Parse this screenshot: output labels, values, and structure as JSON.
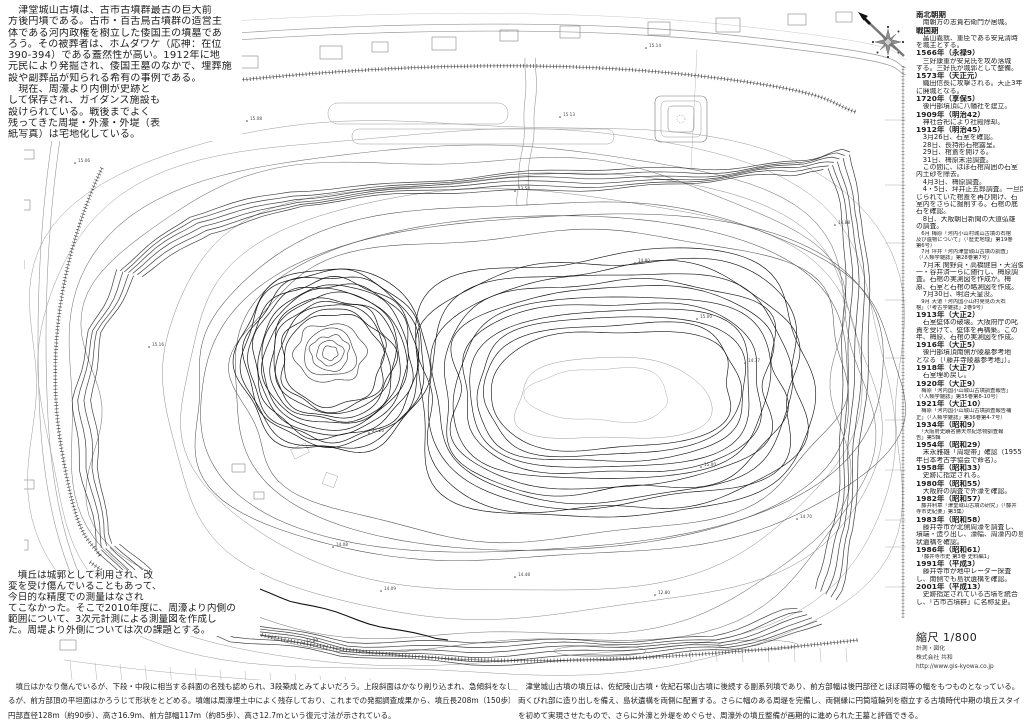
{
  "title": "津堂城山古墳 測量図",
  "intro": {
    "lines": [
      "　津堂城山古墳は、古市古墳群最古の巨大前",
      "方後円墳である。古市・百舌鳥古墳群の造営主",
      "体である河内政権を樹立した倭国王の墳墓であ",
      "ろう。その被葬者は、ホムダワケ（応神：在位",
      "390-394）である蓋然性が高い。1912年に地",
      "元民により発掘され、倭国王墓のなかで、埋葬施",
      "設や副葬品が知られる希有の事例である。",
      "　現在、周濠より内側が史跡と",
      "して保存され、ガイダンス施設も",
      "設けられている。戦後までよく",
      "残ってきた周堤・外濠・外堤（表",
      "紙写真）は宅地化している。"
    ]
  },
  "note": {
    "lines": [
      "　墳丘は城郭として利用され、改",
      "変を受け傷んでいることもあって、",
      "今日的な精度での測量はなされ",
      "てこなかった。そこで2010年度に、周濠より内側の",
      "範囲について、3次元計測による測量図を作成し",
      "た。周堤より外側については次の課題とする。"
    ]
  },
  "footer_left": {
    "lines": [
      "　墳丘はかなり傷んでいるが、下段・中段に相当する斜面の名残も認められ、3段築成とみてよいだろう。上段斜面はかなり削り込まれ、急傾斜をなしてい",
      "るが、前方部頂の平坦面はかろうじて形状をとどめる。墳端は周濠埋土中によく残存しており、これまでの発掘調査成果から、墳丘長208m（150歩）、後",
      "円部直径128m（約90歩）、高さ16.9m、前方部幅117m（約85歩）、高さ12.7mという復元寸法が示されている。"
    ]
  },
  "footer_right": {
    "lines": [
      "　津堂城山古墳の墳丘は、佐紀陵山古墳・佐紀石塚山古墳に後続する副系列墳であり、前方部幅は後円部径とほぼ同等の幅をもつものとなっている。",
      "両くびれ部に造り出しを備え、島状遺構を両側に配置する。さらに幅のある周堤を完備し、両側縁に円筒埴輪列を樹立する古墳時代中期の墳丘スタイル",
      "を初めて実現させたもので、さらに外濠と外堤をめぐらせ、周濠外の墳丘整備が画期的に進められた王墓と評価できる。"
    ]
  },
  "timeline": {
    "entries": [
      {
        "c": "year",
        "t": "南北朝期"
      },
      {
        "c": "body",
        "t": "　南朝方の志貴右衛門が居城。"
      },
      {
        "c": "year",
        "t": "戦国期"
      },
      {
        "c": "body",
        "t": "　畠山義就、重臣である安見清時"
      },
      {
        "c": "body",
        "t": "を城主とする。"
      },
      {
        "c": "year",
        "t": "1566年（永禄9）"
      },
      {
        "c": "body",
        "t": "　三好康重が安見氏を攻め落城"
      },
      {
        "c": "body",
        "t": "する。三好氏が城郭として整備。"
      },
      {
        "c": "year",
        "t": "1573年（天正元）"
      },
      {
        "c": "body",
        "t": "　織田信長に攻撃される。天正3年"
      },
      {
        "c": "body",
        "t": "に廃城となる。"
      },
      {
        "c": "year",
        "t": "1720年（享保5）"
      },
      {
        "c": "body",
        "t": "　後円部墳頂に八幡社を建立。"
      },
      {
        "c": "year",
        "t": "1909年（明治42）"
      },
      {
        "c": "body",
        "t": "　神社合祀により社殿除却。"
      },
      {
        "c": "year",
        "t": "1912年（明治45）"
      },
      {
        "c": "body",
        "t": "　3月26日、石室を確認。"
      },
      {
        "c": "body",
        "t": "　28日、長持形石棺露呈。"
      },
      {
        "c": "body",
        "t": "　29日、棺蓋を開ける。"
      },
      {
        "c": "body",
        "t": "　31日、梅原末治調査。"
      },
      {
        "c": "body",
        "t": "　この間に、ほぼ石棺周囲の石室"
      },
      {
        "c": "body",
        "t": "内土砂を除去。"
      },
      {
        "c": "body",
        "t": "　4月3日、梅原調査。"
      },
      {
        "c": "body",
        "t": "　4・5日、坪井正五郎調査。一旦閉"
      },
      {
        "c": "body",
        "t": "じられていた棺蓋を再び開け、石"
      },
      {
        "c": "body",
        "t": "室内をさらに掘削する。石棺の底"
      },
      {
        "c": "body",
        "t": "石を確認。"
      },
      {
        "c": "body",
        "t": "　8日、大阪朝日新聞の大道弘雄"
      },
      {
        "c": "body",
        "t": "の調査。"
      },
      {
        "c": "cite",
        "t": "　6月 梅原「河内小山村城山古墳の石棺"
      },
      {
        "c": "cite",
        "t": "及び遺物について」（「歴史地理」第19巻"
      },
      {
        "c": "cite",
        "t": "第6号）"
      },
      {
        "c": "cite",
        "t": "　7月 坪井「河内津堂城山古墳の調査」"
      },
      {
        "c": "cite",
        "t": "（「人類学雑誌」第28巻第7号）"
      },
      {
        "c": "body",
        "t": "　7月末 関野貞・高橋健自・天沼俊"
      },
      {
        "c": "body",
        "t": "一・谷井済一らに随行し、梅原調"
      },
      {
        "c": "body",
        "t": "査。石棺の実測図を作成か。梅"
      },
      {
        "c": "body",
        "t": "原、石室と石棺の略測図を作成。"
      },
      {
        "c": "body",
        "t": "　7月30日、明治天皇没。"
      },
      {
        "c": "cite",
        "t": "　9月 大道「河内国小山村発見の大石"
      },
      {
        "c": "cite",
        "t": "棺」（「考古学雑誌」2巻9号）"
      },
      {
        "c": "year",
        "t": "1913年（大正2）"
      },
      {
        "c": "body",
        "t": "　石室壁体の破壊。大阪府庁の叱"
      },
      {
        "c": "body",
        "t": "責を受けて、壁体を再構築。この"
      },
      {
        "c": "body",
        "t": "年、梅原、石棺の実測図を作成。"
      },
      {
        "c": "year",
        "t": "1916年（大正5）"
      },
      {
        "c": "body",
        "t": "　後円部墳頂南側が陵墓参考地"
      },
      {
        "c": "body",
        "t": "となる（「藤井寺陵墓参考地」）。"
      },
      {
        "c": "year",
        "t": "1918年（大正7）"
      },
      {
        "c": "body",
        "t": "　石室埋め戻し。"
      },
      {
        "c": "year",
        "t": "1920年（大正9）"
      },
      {
        "c": "cite",
        "t": "　梅原「河内国小山城山古墳調査報告」"
      },
      {
        "c": "cite",
        "t": "（「人類学雑誌」第35巻第8-10号）"
      },
      {
        "c": "year",
        "t": "1921年（大正10）"
      },
      {
        "c": "cite",
        "t": "　梅原「河内国小山城山古墳調査報告補"
      },
      {
        "c": "cite",
        "t": "正」（「人類学雑誌」第36巻第4-7号）"
      },
      {
        "c": "year",
        "t": "1934年（昭和9）"
      },
      {
        "c": "cite",
        "t": "　「大阪府史蹟名勝天然紀念物調査報"
      },
      {
        "c": "cite",
        "t": "告」第5輯"
      },
      {
        "c": "year",
        "t": "1954年（昭和29）"
      },
      {
        "c": "body",
        "t": "　末永雅雄「周堤帯」確認（1955"
      },
      {
        "c": "body",
        "t": "年日本考古学協会で命名）。"
      },
      {
        "c": "year",
        "t": "1958年（昭和33）"
      },
      {
        "c": "body",
        "t": "　史跡に指定される。"
      },
      {
        "c": "year",
        "t": "1980年（昭和55）"
      },
      {
        "c": "body",
        "t": "　大阪府の調査で外濠を確認。"
      },
      {
        "c": "year",
        "t": "1982年（昭和57）"
      },
      {
        "c": "cite",
        "t": "　藤井利章「津堂城山古墳の研究」（「藤井"
      },
      {
        "c": "cite",
        "t": "寺市史紀要」第3集）"
      },
      {
        "c": "year",
        "t": "1983年（昭和58）"
      },
      {
        "c": "body",
        "t": "　藤井寺市が北側周濠を調査し、"
      },
      {
        "c": "body",
        "t": "墳端・造り出し、濠幅、周濠内の島"
      },
      {
        "c": "body",
        "t": "状遺構を確認。"
      },
      {
        "c": "year",
        "t": "1986年（昭和61）"
      },
      {
        "c": "cite",
        "t": "　「藤井寺市史 第3巻 史料編1」"
      },
      {
        "c": "year",
        "t": "1991年（平成3）"
      },
      {
        "c": "body",
        "t": "　藤井寺市が地中レーダー探査"
      },
      {
        "c": "body",
        "t": "し、南側でも島状遺構を確認。"
      },
      {
        "c": "year",
        "t": "2001年（平成13）"
      },
      {
        "c": "body",
        "t": "　史跡指定されている古墳を統合"
      },
      {
        "c": "body",
        "t": "し、「古市古墳群」に名称変更。"
      }
    ]
  },
  "scale_block": {
    "scale": "縮尺 1/800",
    "credit1": "計測・図化",
    "credit2": "株式会社 共和",
    "url": "http://www.gis-kyowa.co.jp"
  },
  "map": {
    "colors": {
      "contour_dark": "#161616",
      "contour_mid": "#2e2e2e",
      "contour_light": "#8a8a8a",
      "faint": "#aaaaaa",
      "label": "#444444"
    },
    "labels": [
      {
        "x": 563,
        "y": 116,
        "v": "15.13"
      },
      {
        "x": 649,
        "y": 47,
        "v": "15.14"
      },
      {
        "x": 78,
        "y": 162,
        "v": "15.06"
      },
      {
        "x": 518,
        "y": 190,
        "v": "13.54"
      },
      {
        "x": 838,
        "y": 224,
        "v": "14.88"
      },
      {
        "x": 700,
        "y": 318,
        "v": "15.00"
      },
      {
        "x": 748,
        "y": 362,
        "v": "14.77"
      },
      {
        "x": 372,
        "y": 432,
        "v": "21.20"
      },
      {
        "x": 336,
        "y": 546,
        "v": "14.08"
      },
      {
        "x": 384,
        "y": 590,
        "v": "14.09"
      },
      {
        "x": 518,
        "y": 576,
        "v": "14.48"
      },
      {
        "x": 658,
        "y": 594,
        "v": "12.80"
      },
      {
        "x": 306,
        "y": 642,
        "v": "12.80"
      },
      {
        "x": 572,
        "y": 710,
        "v": "12.88"
      },
      {
        "x": 152,
        "y": 346,
        "v": "15.16"
      },
      {
        "x": 800,
        "y": 518,
        "v": "14.70"
      },
      {
        "x": 704,
        "y": 466,
        "v": "15.00"
      },
      {
        "x": 638,
        "y": 262,
        "v": "14.80"
      },
      {
        "x": 250,
        "y": 120,
        "v": "15.08"
      }
    ]
  }
}
